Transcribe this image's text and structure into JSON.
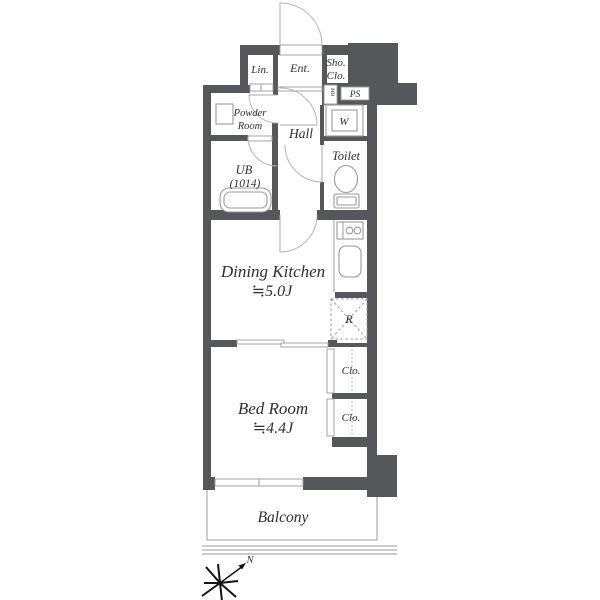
{
  "plan": {
    "labels": {
      "lin": "Lin.",
      "ent": "Ent.",
      "sho_clo_1": "Sho.",
      "sho_clo_2": "Clo.",
      "ps": "PS",
      "mb": "MB",
      "washer": "W",
      "powder_1": "Powder",
      "powder_2": "Room",
      "hall": "Hall",
      "toilet": "Toilet",
      "ub_1": "UB",
      "ub_2": "(1014)",
      "dk_1": "Dining Kitchen",
      "dk_2": "≒5.0J",
      "fridge": "R",
      "clo_upper": "Clo.",
      "clo_lower": "Clo.",
      "bed_1": "Bed Room",
      "bed_2": "≒4.4J",
      "balcony": "Balcony",
      "north": "N"
    },
    "areas": {
      "dining_kitchen_size": "≒5.0J",
      "bed_room_size": "≒4.4J",
      "unit_bath_size": "(1014)"
    },
    "colors": {
      "wall": "#56575b",
      "thin_line": "#9b9b9b",
      "door_arc": "#b7b7b7",
      "text": "#2f2f2f",
      "background": "#ffffff"
    }
  }
}
